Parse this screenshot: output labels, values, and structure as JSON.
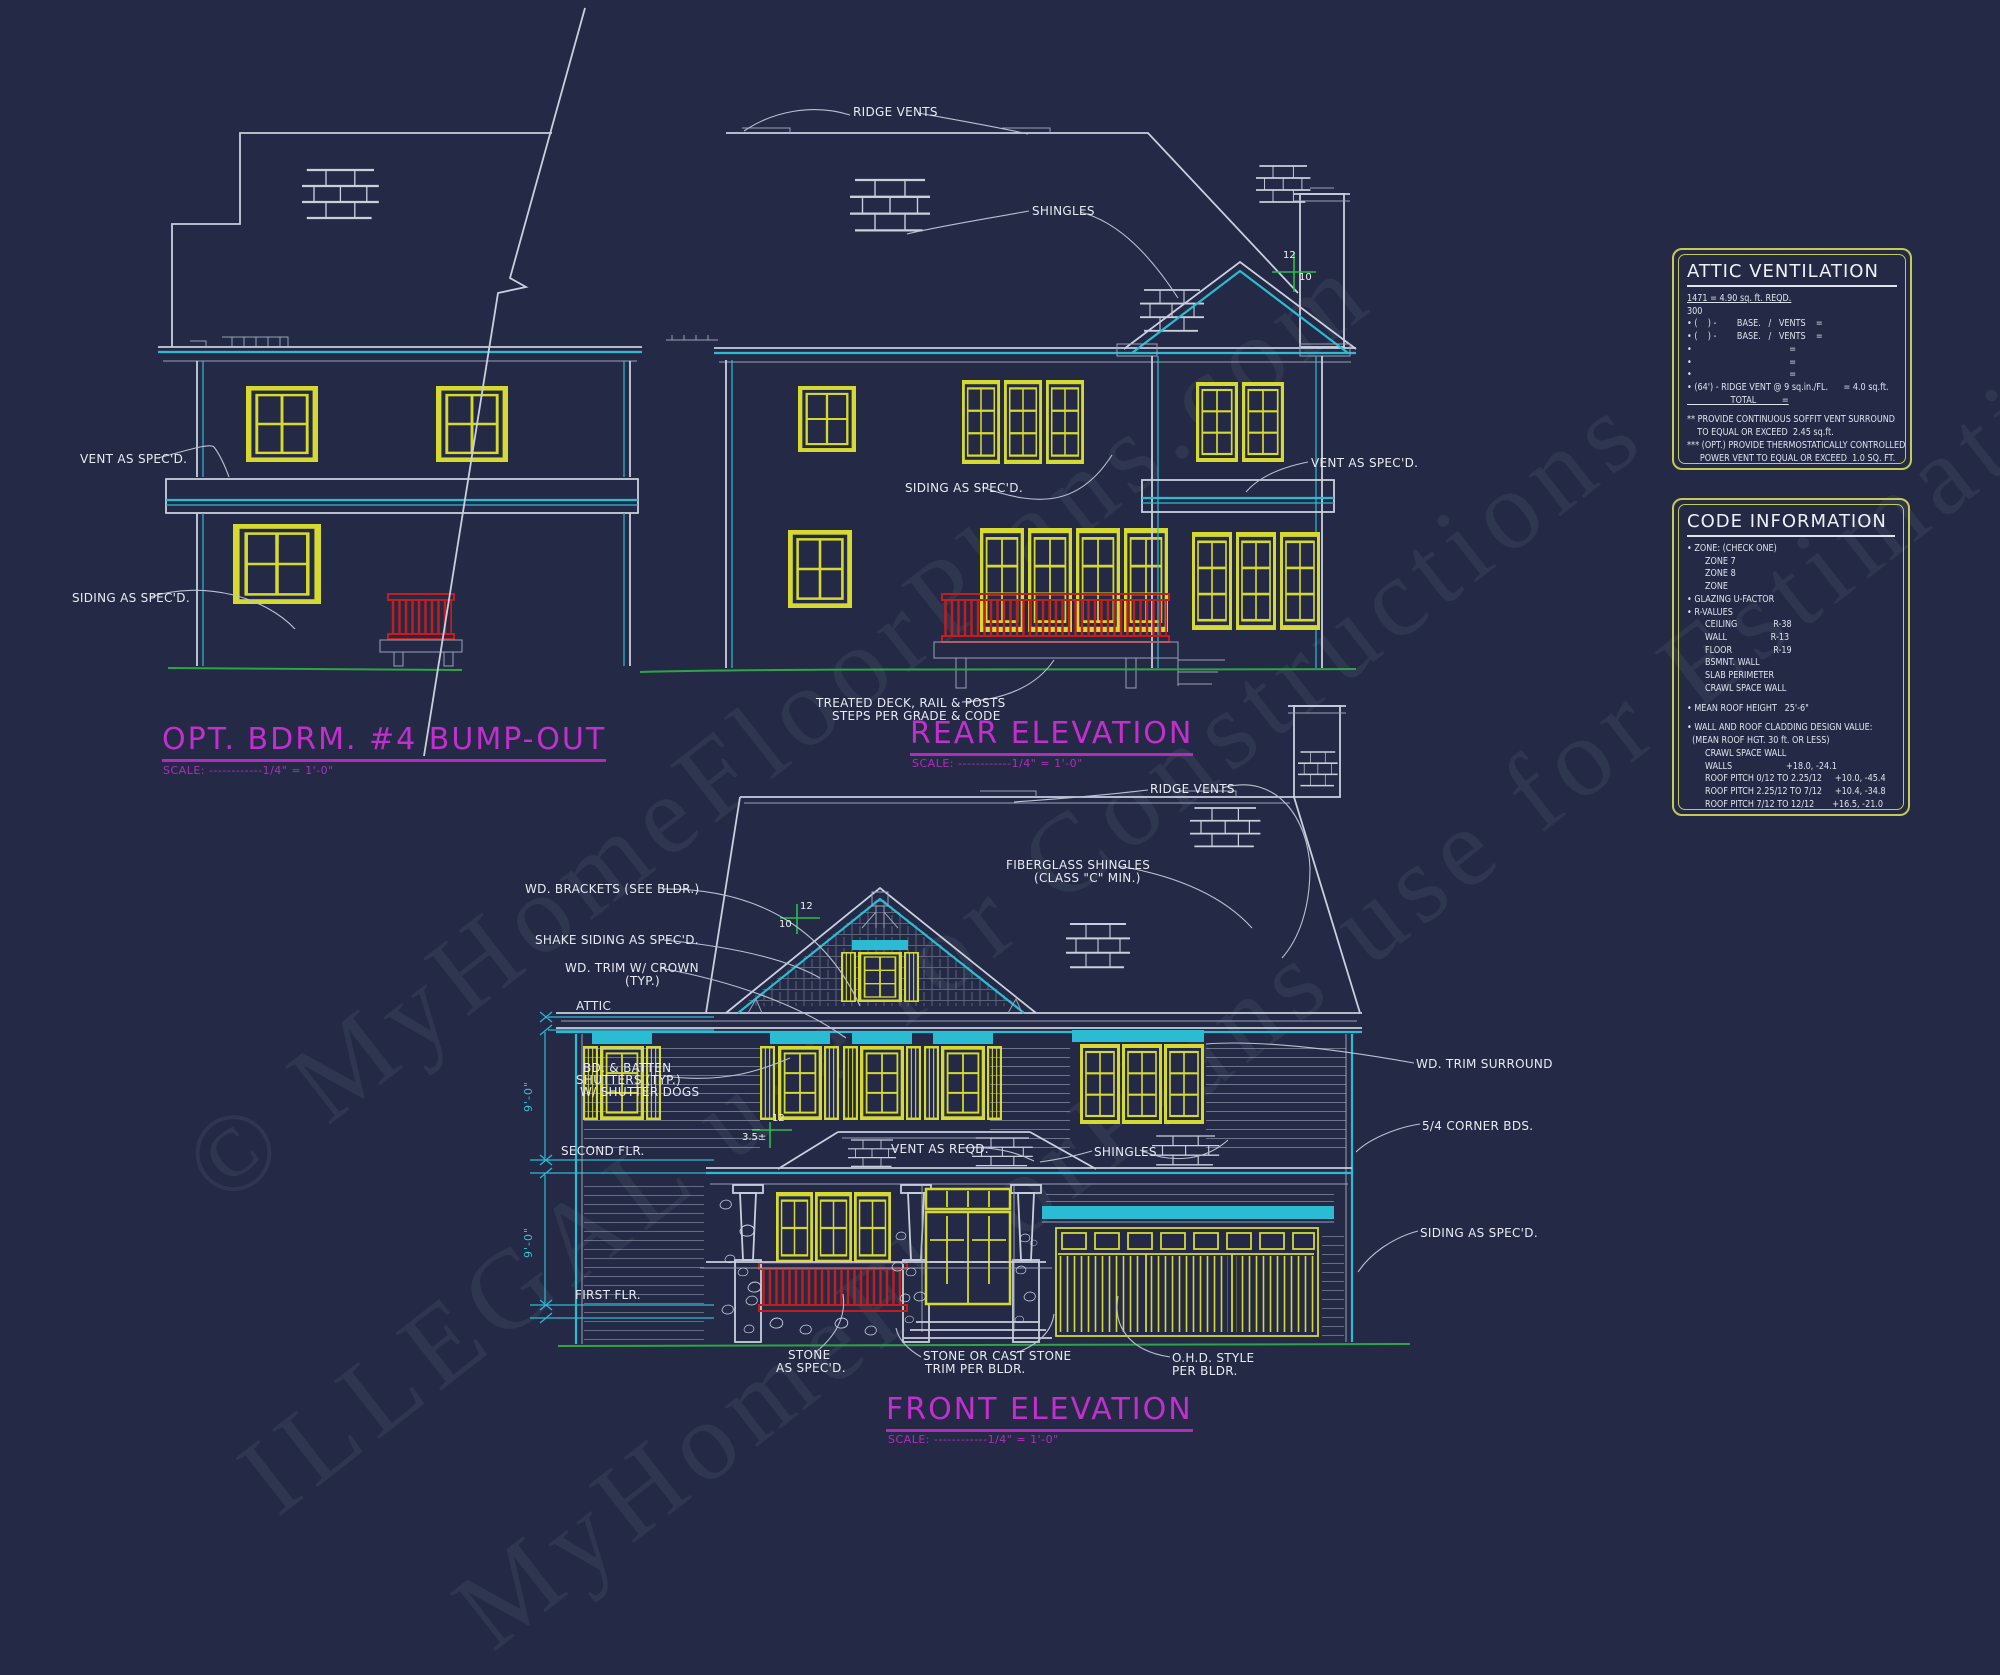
{
  "watermark": {
    "line1": "© MyHomeFloorPlans.com",
    "line2": "ILLEGAL use for Constructions",
    "line3": "MyHomeFloorPlans use for Estimations"
  },
  "titles": {
    "bump_out": {
      "name": "OPT. BDRM. #4 BUMP-OUT",
      "scale": "SCALE: ------------1/4\" = 1'-0\""
    },
    "rear": {
      "name": "REAR ELEVATION",
      "scale": "SCALE: ------------1/4\" = 1'-0\""
    },
    "front": {
      "name": "FRONT ELEVATION",
      "scale": "SCALE: ------------1/4\" = 1'-0\""
    }
  },
  "labels": {
    "left_vent": "VENT AS SPEC'D.",
    "left_siding": "SIDING AS SPEC'D.",
    "rear_ridge_vents": "RIDGE VENTS",
    "rear_shingles": "SHINGLES",
    "rear_siding": "SIDING AS SPEC'D.",
    "rear_vent": "VENT AS SPEC'D.",
    "rear_deck1": "TREATED DECK, RAIL & POSTS",
    "rear_deck2": "STEPS PER GRADE & CODE",
    "front_ridge_vents": "RIDGE VENTS",
    "front_fiberglass1": "FIBERGLASS SHINGLES",
    "front_fiberglass2": "(CLASS \"C\" MIN.)",
    "front_brackets": "WD. BRACKETS (SEE BLDR.)",
    "front_shake": "SHAKE SIDING AS SPEC'D.",
    "front_trim_crown1": "WD. TRIM W/ CROWN",
    "front_trim_crown2": "(TYP.)",
    "front_attic": "ATTIC",
    "front_shutters1": "BD. & BATTEN",
    "front_shutters2": "SHUTTERS (TYP.)",
    "front_shutters3": "W/ SHUTTER DOGS",
    "front_second_flr": "SECOND FLR.",
    "front_first_flr": "FIRST FLR.",
    "front_dim_a": "9'-0\"",
    "front_dim_b": "9'-0\"",
    "front_vent_reqd": "VENT AS REQD.",
    "front_shingles": "SHINGLES",
    "front_trim_surround": "WD. TRIM SURROUND",
    "front_corner_bds": "5/4 CORNER BDS.",
    "front_siding": "SIDING AS SPEC'D.",
    "front_stone1": "STONE",
    "front_stone2": "AS SPEC'D.",
    "front_cast1": "STONE OR CAST STONE",
    "front_cast2": "TRIM PER BLDR.",
    "front_ohd1": "O.H.D. STYLE",
    "front_ohd2": "PER BLDR.",
    "pitch_rear_run": "12",
    "pitch_rear_rise": "10",
    "pitch_front_run": "12",
    "pitch_front_rise": "10",
    "pitch_porch_run": "12",
    "pitch_porch_rise": "3.5±"
  },
  "panels": {
    "attic": {
      "title": "ATTIC VENTILATION",
      "lines": [
        "1471 = 4.90 sq. ft. REQD.",
        "300",
        "• (    ) -        BASE.   /   VENTS    =",
        "• (    ) -        BASE.   /   VENTS    =",
        "•                                      =",
        "•                                      =",
        "•                                      =",
        "• (64') - RIDGE VENT @ 9 sq.in./FL.      = 4.0 sq.ft.",
        "                 TOTAL          =",
        "** PROVIDE CONTINUOUS SOFFIT VENT SURROUND",
        "    TO EQUAL OR EXCEED  2.45 sq.ft.",
        "*** (OPT.) PROVIDE THERMOSTATICALLY CONTROLLED",
        "     POWER VENT TO EQUAL OR EXCEED  1.0 SQ. FT."
      ]
    },
    "code": {
      "title": "CODE INFORMATION",
      "lines": [
        "• ZONE: (CHECK ONE)",
        "       ZONE 7",
        "       ZONE 8",
        "       ZONE",
        "• GLAZING U-FACTOR",
        "• R-VALUES",
        "       CEILING              R-38",
        "       WALL                 R-13",
        "       FLOOR                R-19",
        "       BSMNT. WALL",
        "       SLAB PERIMETER",
        "       CRAWL SPACE WALL",
        "• MEAN ROOF HEIGHT   25'-6\"",
        "• WALL AND ROOF CLADDING DESIGN VALUE:",
        "  (MEAN ROOF HGT. 30 ft. OR LESS)",
        "       CRAWL SPACE WALL",
        "       WALLS                     +18.0, -24.1",
        "       ROOF PITCH 0/12 TO 2.25/12     +10.0, -45.4",
        "       ROOF PITCH 2.25/12 TO 7/12     +10.4, -34.8",
        "       ROOF PITCH 7/12 TO 12/12       +16.5, -21.0",
        "       EXPOSURE ADJUSTMENT          x"
      ]
    }
  },
  "colors": {
    "background": "#242a45",
    "line": "#c9cfdd",
    "cyan": "#2bbcd4",
    "yellow": "#d6d92f",
    "red": "#c41d1d",
    "green": "#2da545",
    "magenta": "#c32ecf",
    "panel_border": "#c6ca52"
  }
}
